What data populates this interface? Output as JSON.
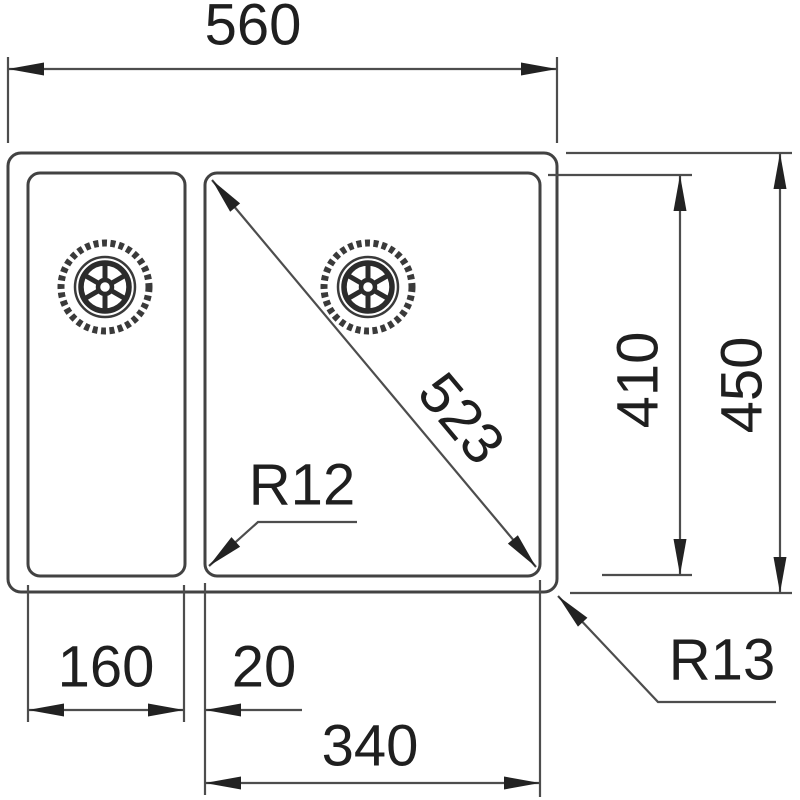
{
  "drawing": {
    "background_color": "#ffffff",
    "line_color": "#4d4d4d",
    "outline_color": "#424242",
    "text_color": "#1f1f1f",
    "labels": {
      "overall_width": "560",
      "overall_depth": "450",
      "bowl_depth": "410",
      "bowl_diagonal": "523",
      "left_bowl_width": "160",
      "divider_width": "20",
      "main_bowl_width": "340",
      "inner_corner_radius": "R12",
      "outer_corner_radius": "R13"
    }
  }
}
